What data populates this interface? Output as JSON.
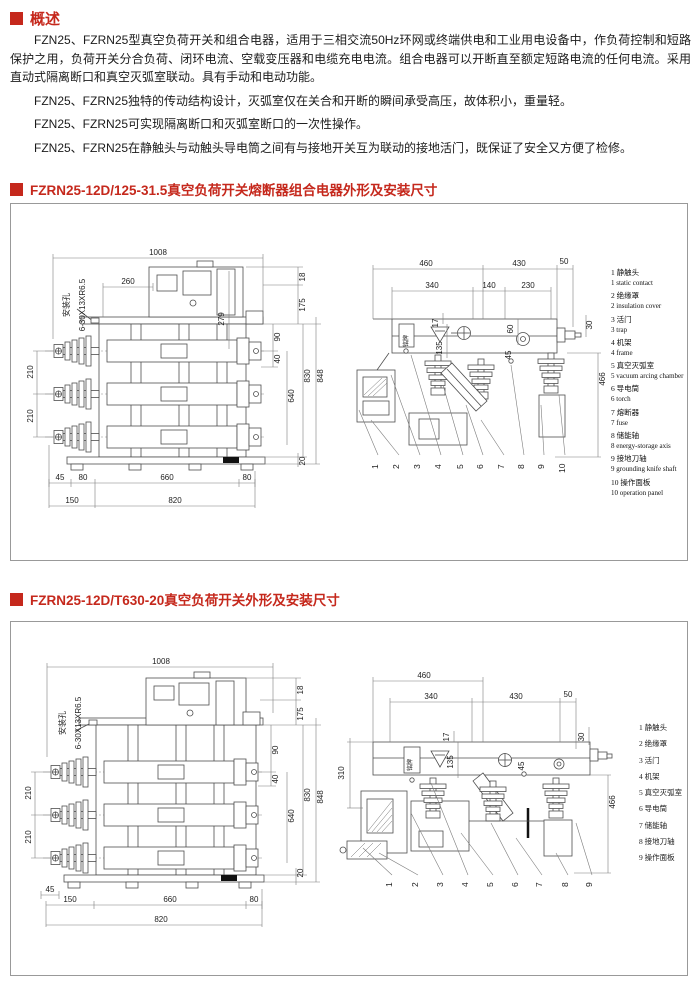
{
  "page": {
    "accent": "#c5281c"
  },
  "overview": {
    "title": "概述",
    "paragraphs": [
      "FZN25、FZRN25型真空负荷开关和组合电器，适用于三相交流50Hz环网或终端供电和工业用电设备中，作负荷控制和短路保护之用，负荷开关分合负荷、闭环电流、空载变压器和电缆充电电流。组合电器可以开断直至额定短路电流的任何电流。采用直动式隔离断口和真空灭弧室联动。具有手动和电动功能。",
      "FZN25、FZRN25独特的传动结构设计，灭弧室仅在关合和开断的瞬间承受高压，故体积小，重量轻。",
      "FZN25、FZRN25可实现隔离断口和灭弧室断口的一次性操作。",
      "FZN25、FZRN25在静触头与动触头导电筒之间有与接地开关互为联动的接地活门，既保证了安全又方便了检修。"
    ]
  },
  "section1": {
    "title": "FZRN25-12D/125-31.5真空负荷开关熔断器组合电器外形及安装尺寸",
    "front": {
      "mount_hole": "安装孔",
      "mount_spec": "6-30X13XR6.5",
      "d1008": "1008",
      "d260": "260",
      "d279": "279",
      "d18": "18",
      "d175": "175",
      "d90": "90",
      "d40": "40",
      "d830": "830",
      "d848": "848",
      "d210a": "210",
      "d210b": "210",
      "d640": "640",
      "d20": "20",
      "d45": "45",
      "d80a": "80",
      "d660": "660",
      "d80b": "80",
      "d150": "150",
      "d820": "820"
    },
    "side": {
      "nameplate": "铭牌",
      "d460": "460",
      "d430": "430",
      "d50": "50",
      "d340": "340",
      "d140": "140",
      "d230": "230",
      "d17": "17",
      "d135": "135",
      "d60": "60",
      "d45": "45",
      "d30": "30",
      "d466": "466"
    },
    "parts": [
      {
        "zh": "1 静触头",
        "en": "1 static contact"
      },
      {
        "zh": "2 绝缘罩",
        "en": "2 insulation cover"
      },
      {
        "zh": "3 活门",
        "en": "3 trap"
      },
      {
        "zh": "4 机架",
        "en": "4 frame"
      },
      {
        "zh": "5 真空灭弧室",
        "en": "5 vacuum arcing chamber"
      },
      {
        "zh": "6 导电筒",
        "en": "6 torch"
      },
      {
        "zh": "7 熔断器",
        "en": "7 fuse"
      },
      {
        "zh": "8 储能轴",
        "en": "8 energy-storage axis"
      },
      {
        "zh": "9 接地刀轴",
        "en": "9 grounding knife shaft"
      },
      {
        "zh": "10 操作面板",
        "en": "10 operation panel"
      }
    ],
    "callouts": [
      "1",
      "2",
      "3",
      "4",
      "5",
      "6",
      "7",
      "8",
      "9",
      "10"
    ]
  },
  "section2": {
    "title": "FZRN25-12D/T630-20真空负荷开关外形及安装尺寸",
    "front": {
      "mount_hole": "安装孔",
      "mount_spec": "6-30X13XR6.5",
      "d1008": "1008",
      "d18": "18",
      "d175": "175",
      "d90": "90",
      "d40": "40",
      "d830": "830",
      "d848": "848",
      "d210a": "210",
      "d210b": "210",
      "d640": "640",
      "d20": "20",
      "d45": "45",
      "d150": "150",
      "d660": "660",
      "d80": "80",
      "d820": "820"
    },
    "side": {
      "nameplate": "铭牌",
      "d460": "460",
      "d340": "340",
      "d430": "430",
      "d50": "50",
      "d310": "310",
      "d17": "17",
      "d135": "135",
      "d45": "45",
      "d30": "30",
      "d466": "466"
    },
    "parts": [
      {
        "zh": "1 静触头"
      },
      {
        "zh": "2 绝缘罩"
      },
      {
        "zh": "3 活门"
      },
      {
        "zh": "4 机架"
      },
      {
        "zh": "5 真空灭弧室"
      },
      {
        "zh": "6 导电筒"
      },
      {
        "zh": "7 储能轴"
      },
      {
        "zh": "8 接地刀轴"
      },
      {
        "zh": "9 操作面板"
      }
    ],
    "callouts": [
      "1",
      "2",
      "3",
      "4",
      "5",
      "6",
      "7",
      "8",
      "9"
    ]
  }
}
